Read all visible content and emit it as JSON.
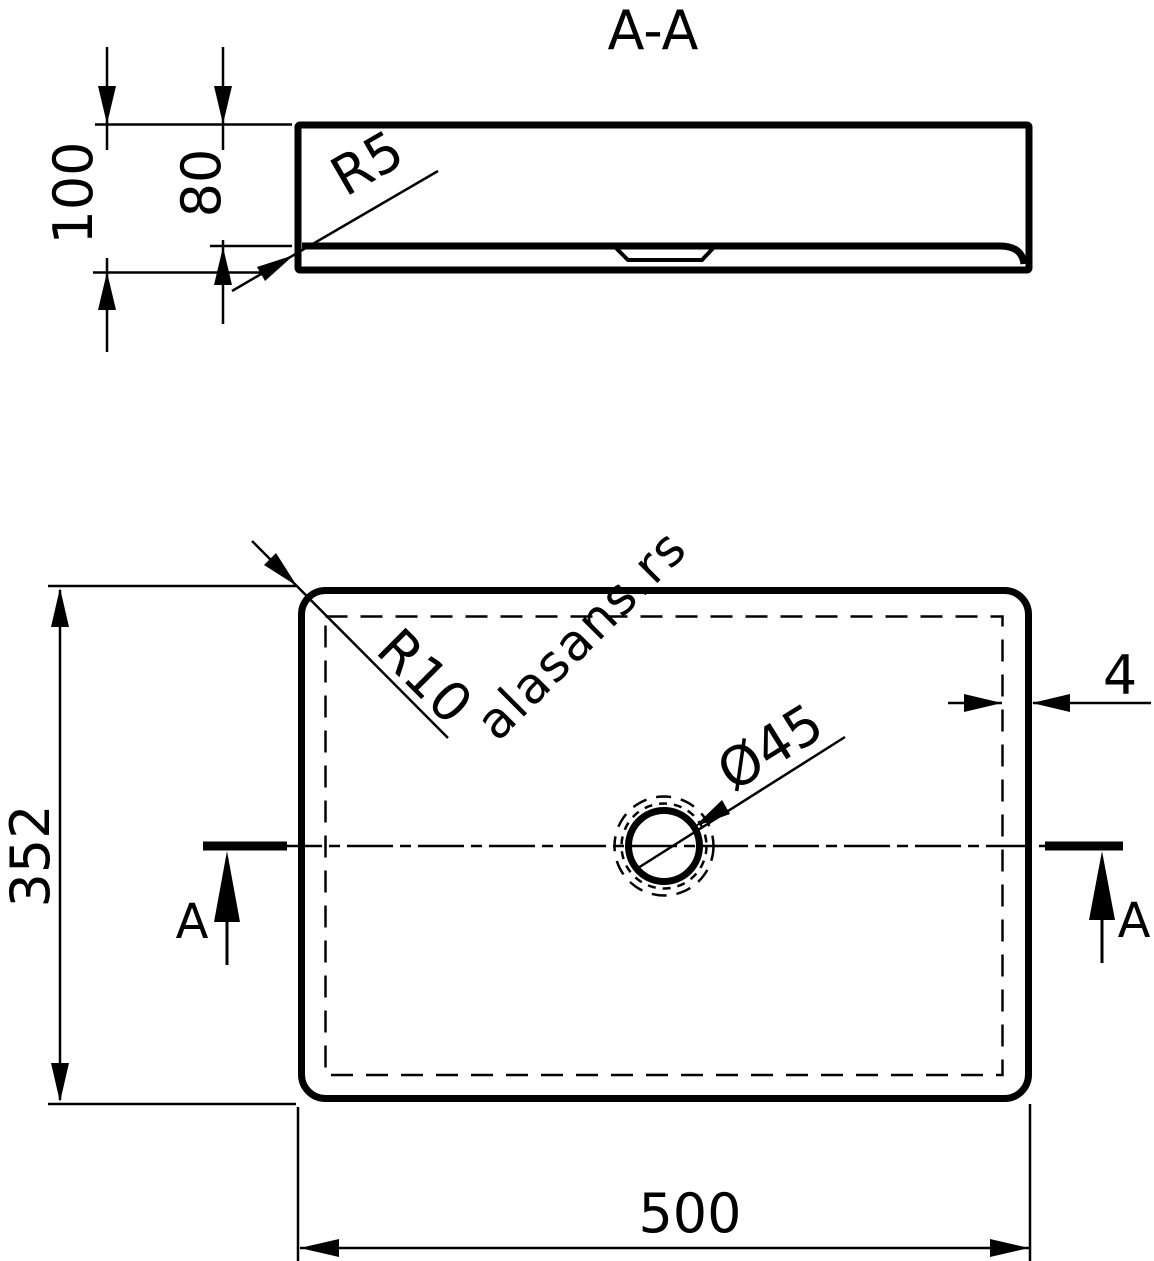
{
  "watermark": {
    "text": "alasans.rs",
    "color": "#d7d7d7"
  },
  "drawing": {
    "line_color": "#000000",
    "background_color": "#ffffff"
  },
  "section_view": {
    "title": "A-A",
    "dim_overall_height": "100",
    "dim_basin_inner_depth": "80",
    "dim_bottom_corner_radius": "R5"
  },
  "plan_view": {
    "dim_depth": "352",
    "dim_width": "500",
    "dim_rim_thickness": "4",
    "dim_corner_radius": "R10",
    "dim_drain_diameter": "Ø45",
    "section_marker_left": "A",
    "section_marker_right": "A"
  }
}
